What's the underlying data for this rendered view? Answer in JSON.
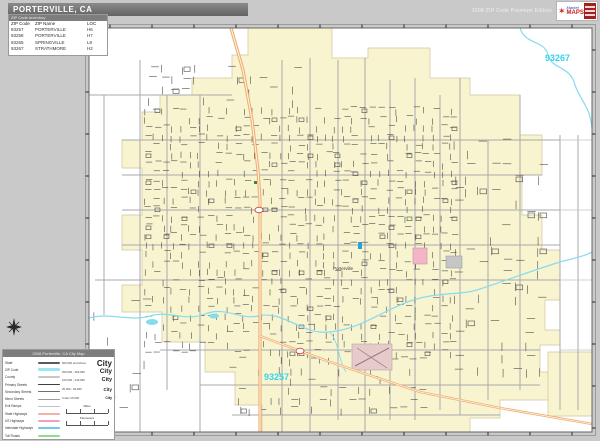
{
  "header": {
    "title": "PORTERVILLE, CA",
    "edition": "2008 ZIP Code Premium Edition",
    "logo": {
      "line1": "Market",
      "line2": "MAPS"
    }
  },
  "zip_table": {
    "header_bar": "ZIP Code Inventory",
    "columns": [
      "ZIP Code",
      "ZIP Name",
      "LOC"
    ],
    "rows": [
      [
        "93257",
        "PORTERVILLE",
        "H6"
      ],
      [
        "93258",
        "PORTERVILLE",
        "H7"
      ],
      [
        "93265",
        "SPRINGVILLE",
        "L8"
      ],
      [
        "93267",
        "STRATHMORE",
        "H2"
      ]
    ]
  },
  "map": {
    "labels": {
      "city": "Porterville",
      "zip_main": "93257",
      "zip_northeast": "93267"
    },
    "colors": {
      "zip_fill": "#f8f4d0",
      "zip_label": "#35d3ee",
      "river": "#86dcee",
      "highway": "#efae72",
      "minor_street": "#3d3d3d",
      "major_road": "#a8a8a8",
      "frame": "#666666",
      "page_bg": "#c9c9c9"
    }
  },
  "legend": {
    "title": "2008 Porterville, CA City Map",
    "line_items": [
      {
        "label": "State",
        "color": "#5a5a5a",
        "height": 2.2
      },
      {
        "label": "ZIP Code",
        "color": "#9fe6f2",
        "height": 3
      },
      {
        "label": "County",
        "color": "#c8c8c8",
        "height": 2
      },
      {
        "label": "Primary Streets",
        "color": "#3f3f3f",
        "height": 1.6
      },
      {
        "label": "Secondary Streets",
        "color": "#6e6e6e",
        "height": 1.1
      },
      {
        "label": "Minor Streets",
        "color": "#9a9a9a",
        "height": 0.8
      },
      {
        "label": "Exit Ramps",
        "color": "#c0c0c0",
        "height": 0.8
      },
      {
        "label": "State Highways",
        "color": "#f2b3a6",
        "height": 2.2
      },
      {
        "label": "US Highways",
        "color": "#f09ec2",
        "height": 2.2
      },
      {
        "label": "Interstate Highways",
        "color": "#6fc8ee",
        "height": 2.2
      },
      {
        "label": "Toll Roads",
        "color": "#8ede8e",
        "height": 2.2
      }
    ],
    "city_sizes": [
      {
        "range": "500,000 and Above",
        "sample": "City",
        "size": 8
      },
      {
        "range": "250,000 - 499,999",
        "sample": "City",
        "size": 6.5
      },
      {
        "range": "100,000 - 249,999",
        "sample": "City",
        "size": 5.5
      },
      {
        "range": "25,000 - 99,999",
        "sample": "City",
        "size": 4.5
      },
      {
        "range": "Under 25,000",
        "sample": "City",
        "size": 3.5
      }
    ],
    "scalebars": [
      {
        "label": "Miles"
      },
      {
        "label": "Kilometers"
      }
    ]
  }
}
